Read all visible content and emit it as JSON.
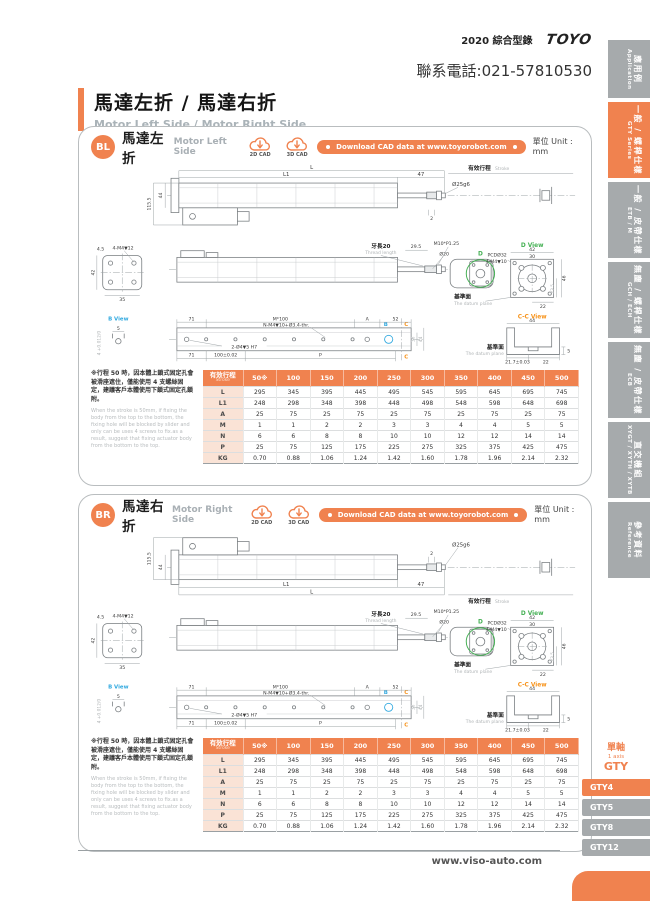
{
  "colors": {
    "accent": "#f0824f",
    "gray": "#a6aaac",
    "cyan": "#2fa8df",
    "green": "#45b054",
    "vorange": "#f7941d"
  },
  "header": {
    "edition": "2020 綜合型錄",
    "logo": "TOYO",
    "phone": "聯系電話:021-57810530"
  },
  "title": {
    "zh": "馬達左折 / 馬達右折",
    "en": "Motor Left Side / Motor Right Side"
  },
  "unit": "單位 Unit : mm",
  "cad": {
    "c2d": "2D CAD",
    "c3d": "3D CAD",
    "download": "Download CAD data at www.toyorobot.com"
  },
  "sections": [
    {
      "badge": "BL",
      "zh": "馬達左折",
      "en": "Motor Left Side"
    },
    {
      "badge": "BR",
      "zh": "馬達右折",
      "en": "Motor Right Side"
    }
  ],
  "drawing": {
    "L": "L",
    "L1": "L1",
    "d47": "47",
    "rod_dia": "Ø25g6",
    "tip2": "2",
    "stroke_zh": "有效行程",
    "stroke_en": "Stroke",
    "h115": "115.5",
    "h44": "44",
    "ev45": "4.5",
    "ev_tap": "4-M4▼12",
    "ev42": "42",
    "ev35": "35",
    "th_zh": "牙長20",
    "th_en": "Thread length",
    "th295": "29.5",
    "m10": "M10*P1.25",
    "d20": "Ø20",
    "dmark": "D",
    "dview": "D View",
    "d42": "42",
    "d30": "30",
    "d46": "46",
    "d235": "23.5",
    "d22": "22",
    "pcd": "PCDØ32",
    "pcd_tap": "4-M4▼10",
    "datum_zh": "基準面",
    "datum_en": "The datum plane",
    "bview": "B View",
    "b5": "5",
    "btol": "4 +0.012/0",
    "bmark": "B",
    "cmark": "C",
    "t71": "71",
    "tpitch": "M*100",
    "tA": "A",
    "t52": "52",
    "ttap": "N-M4▼10+Ø3.4-thr.",
    "tdowel": "2-Ø4▼5 H7",
    "t100": "100±0.02",
    "tP": "P",
    "t36": "36",
    "t44": "44",
    "ccview": "C-C View",
    "cc44": "44",
    "cc5": "5",
    "cc217": "21.7±0.03",
    "cc22": "22"
  },
  "note": {
    "zh": "※行程 50 時，因本體上鎖式固定孔會被滑座遮住，僅能使用 4 支螺絲固定，建議客戶本體使用下鎖式固定孔鎖附。",
    "en": "When the stroke is 50mm, if fixing the body from the top to the bottom, the fixing hole will be blocked by slider and only can be uses 4 screws to fix.as a result, suggest that fixing actuator body from the bottom to the top."
  },
  "table": {
    "header_zh": "有效行程",
    "header_en": "Stroke",
    "strokes": [
      "50※",
      "100",
      "150",
      "200",
      "250",
      "300",
      "350",
      "400",
      "450",
      "500"
    ],
    "rows": [
      {
        "label": "L",
        "values": [
          "295",
          "345",
          "395",
          "445",
          "495",
          "545",
          "595",
          "645",
          "695",
          "745"
        ]
      },
      {
        "label": "L1",
        "values": [
          "248",
          "298",
          "348",
          "398",
          "448",
          "498",
          "548",
          "598",
          "648",
          "698"
        ]
      },
      {
        "label": "A",
        "values": [
          "25",
          "75",
          "25",
          "75",
          "25",
          "75",
          "25",
          "75",
          "25",
          "75"
        ]
      },
      {
        "label": "M",
        "values": [
          "1",
          "1",
          "2",
          "2",
          "3",
          "3",
          "4",
          "4",
          "5",
          "5"
        ]
      },
      {
        "label": "N",
        "values": [
          "6",
          "6",
          "8",
          "8",
          "10",
          "10",
          "12",
          "12",
          "14",
          "14"
        ]
      },
      {
        "label": "P",
        "values": [
          "25",
          "75",
          "125",
          "175",
          "225",
          "275",
          "325",
          "375",
          "425",
          "475"
        ]
      },
      {
        "label": "KG",
        "values": [
          "0.70",
          "0.88",
          "1.06",
          "1.24",
          "1.42",
          "1.60",
          "1.78",
          "1.96",
          "2.14",
          "2.32"
        ]
      }
    ]
  },
  "sidebar": {
    "tabs": [
      {
        "zh": "應用例",
        "en": "Application"
      },
      {
        "zh": "一般 / 螺桿仕樣",
        "en": "GTY Series"
      },
      {
        "zh": "一般 / 皮帶仕樣",
        "en": "ETB / M"
      },
      {
        "zh": "無塵 / 螺桿仕樣",
        "en": "GCH / ECH"
      },
      {
        "zh": "無塵 / 皮帶仕樣",
        "en": "ECB"
      },
      {
        "zh": "直交機組",
        "en": "XYGT / XYTH / XYTB"
      },
      {
        "zh": "參考資料",
        "en": "Reference"
      }
    ]
  },
  "models": {
    "axis_zh": "單軸",
    "axis_en": "1 axis",
    "series": "GTY",
    "items": [
      "GTY4",
      "GTY5",
      "GTY8",
      "GTY12"
    ]
  },
  "footer": {
    "url": "www.viso-auto.com"
  }
}
